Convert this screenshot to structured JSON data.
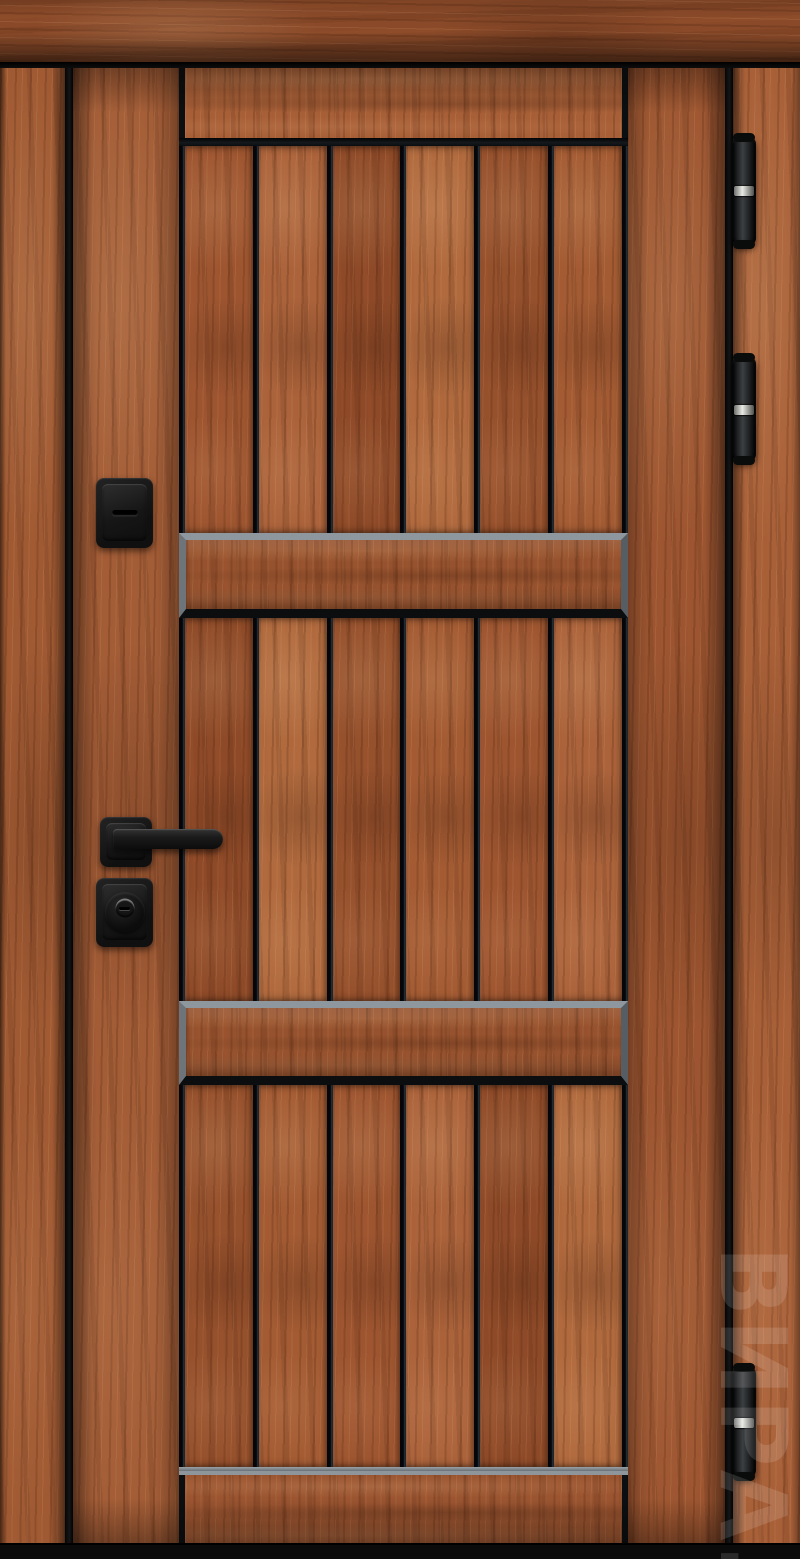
{
  "scene": {
    "subject": "Entrance door with warm wood-grain finish and matte black hardware",
    "view": "front product photo"
  },
  "watermark": {
    "text": "ВИРА."
  },
  "palette": {
    "background": "#060606",
    "wood_mid": "#9d5531",
    "wood_dark": "#8a4a29",
    "wood_light": "#b06a3e",
    "groove_black": "#0b0e10",
    "bevel_gray": "#8e969c",
    "hardware_black": "#17181a",
    "hinge_silver": "#e9e9e5"
  },
  "door": {
    "planks_per_section": 6,
    "plank_sections": 3,
    "horizontal_bands": 2,
    "hinge_count": 3,
    "hardware": [
      "deadbolt-thumbturn-escutcheon",
      "lever-handle",
      "key-cylinder-escutcheon"
    ]
  }
}
